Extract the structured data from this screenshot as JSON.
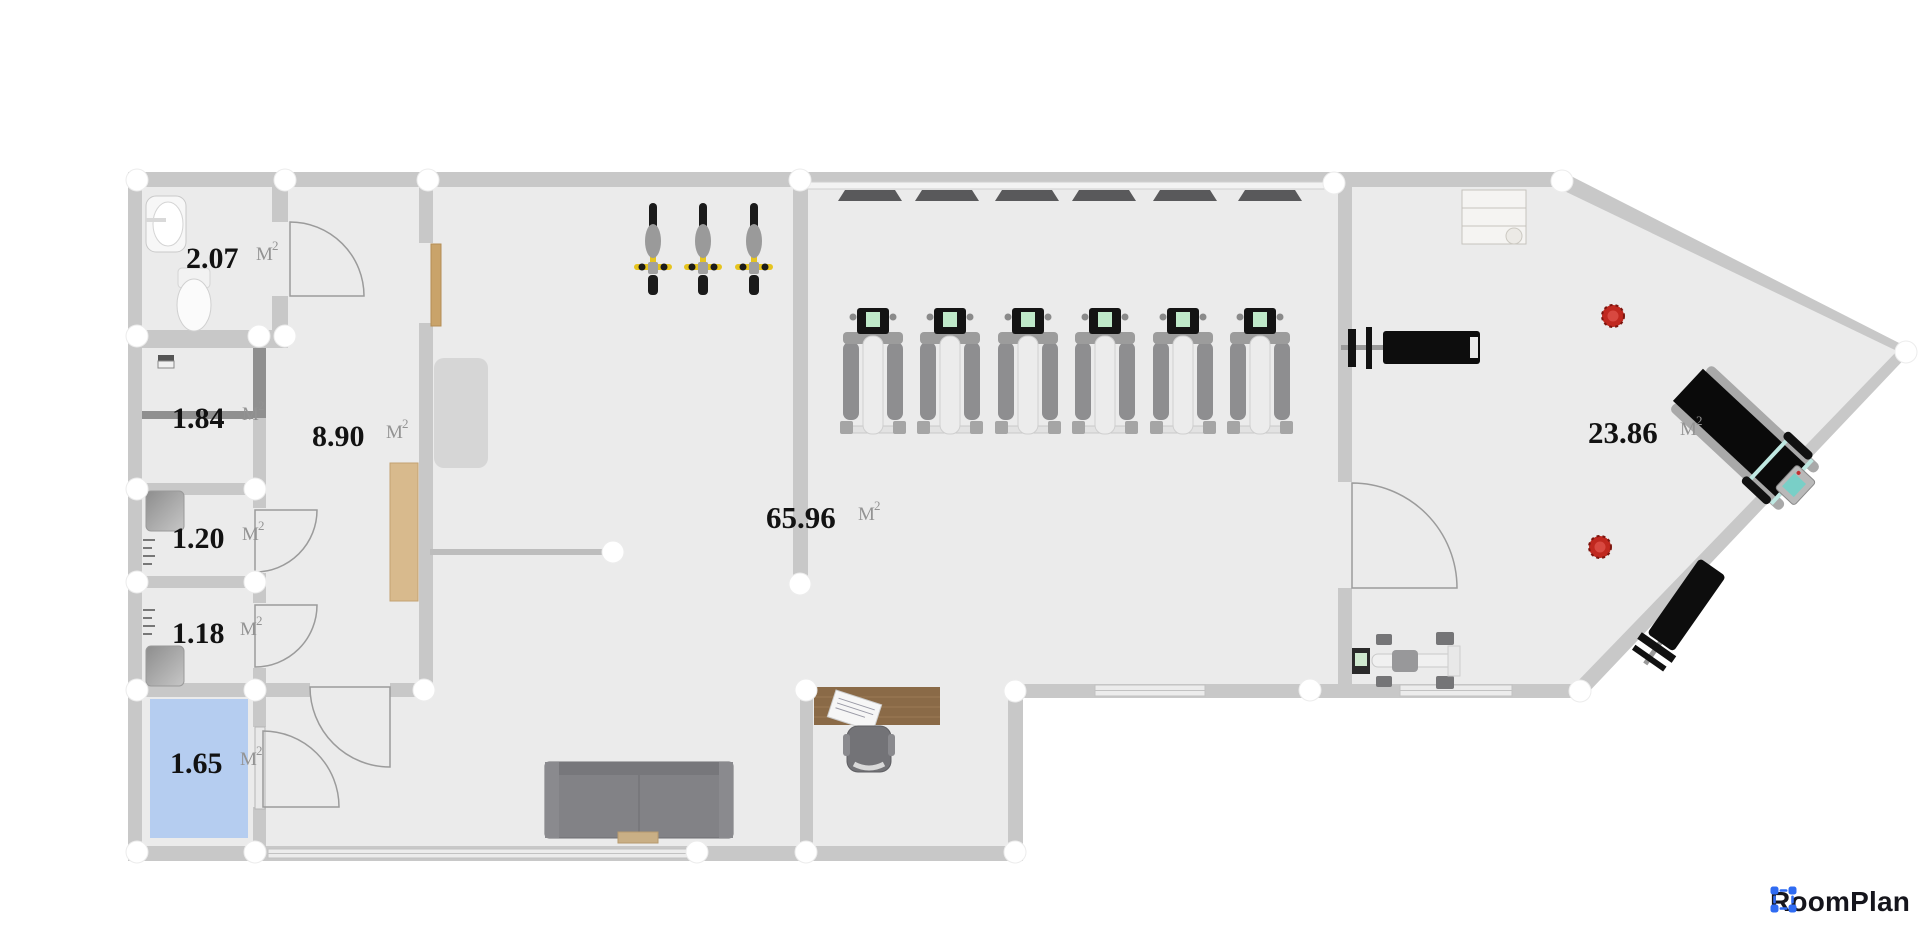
{
  "app": {
    "logo_text": "RoomPlan",
    "logo_color": "#2F6BF2",
    "logo_icon": "selection-corners-icon",
    "logo_text_color": "#15151C"
  },
  "units": {
    "base": "M",
    "exponent": "2"
  },
  "rooms": {
    "wc": {
      "area": "2.07"
    },
    "storage_a": {
      "area": "1.84"
    },
    "shower_a": {
      "area": "1.20"
    },
    "shower_b": {
      "area": "1.18"
    },
    "tech": {
      "area": "1.65",
      "floor_color": "#b5cdf0"
    },
    "hall": {
      "area": "8.90"
    },
    "gym": {
      "area": "65.96"
    },
    "studio": {
      "area": "23.86"
    }
  },
  "colors": {
    "floor": "#ebebeb",
    "wall": "#c8c8c8",
    "wall_dark": "#8f8f8f",
    "highlight_room": "#b5cdf0",
    "bike_yellow": "#e6c41f",
    "plant_red": "#c0281f",
    "wood": "#d8ba8d",
    "desk_wood": "#8a6a47",
    "equipment_black": "#0d0d0d"
  },
  "equipment": [
    {
      "name": "sink",
      "count": 1
    },
    {
      "name": "toilet",
      "count": 1
    },
    {
      "name": "washing-machine",
      "count": 1
    },
    {
      "name": "shower-tray",
      "count": 2
    },
    {
      "name": "radiator",
      "count": 2
    },
    {
      "name": "reception-counter",
      "count": 1
    },
    {
      "name": "storage-mat",
      "count": 1
    },
    {
      "name": "door",
      "count": 6
    },
    {
      "name": "exercise-mat",
      "count": 6
    },
    {
      "name": "spin-bike",
      "count": 3
    },
    {
      "name": "elliptical-trainer",
      "count": 6
    },
    {
      "name": "bench-press",
      "count": 2
    },
    {
      "name": "treadmill",
      "count": 1
    },
    {
      "name": "rowing-machine",
      "count": 1
    },
    {
      "name": "sofa",
      "count": 1
    },
    {
      "name": "coffee-table",
      "count": 1
    },
    {
      "name": "office-desk",
      "count": 1
    },
    {
      "name": "office-chair",
      "count": 1
    },
    {
      "name": "shelf-rack",
      "count": 1
    },
    {
      "name": "plant",
      "count": 2
    }
  ]
}
